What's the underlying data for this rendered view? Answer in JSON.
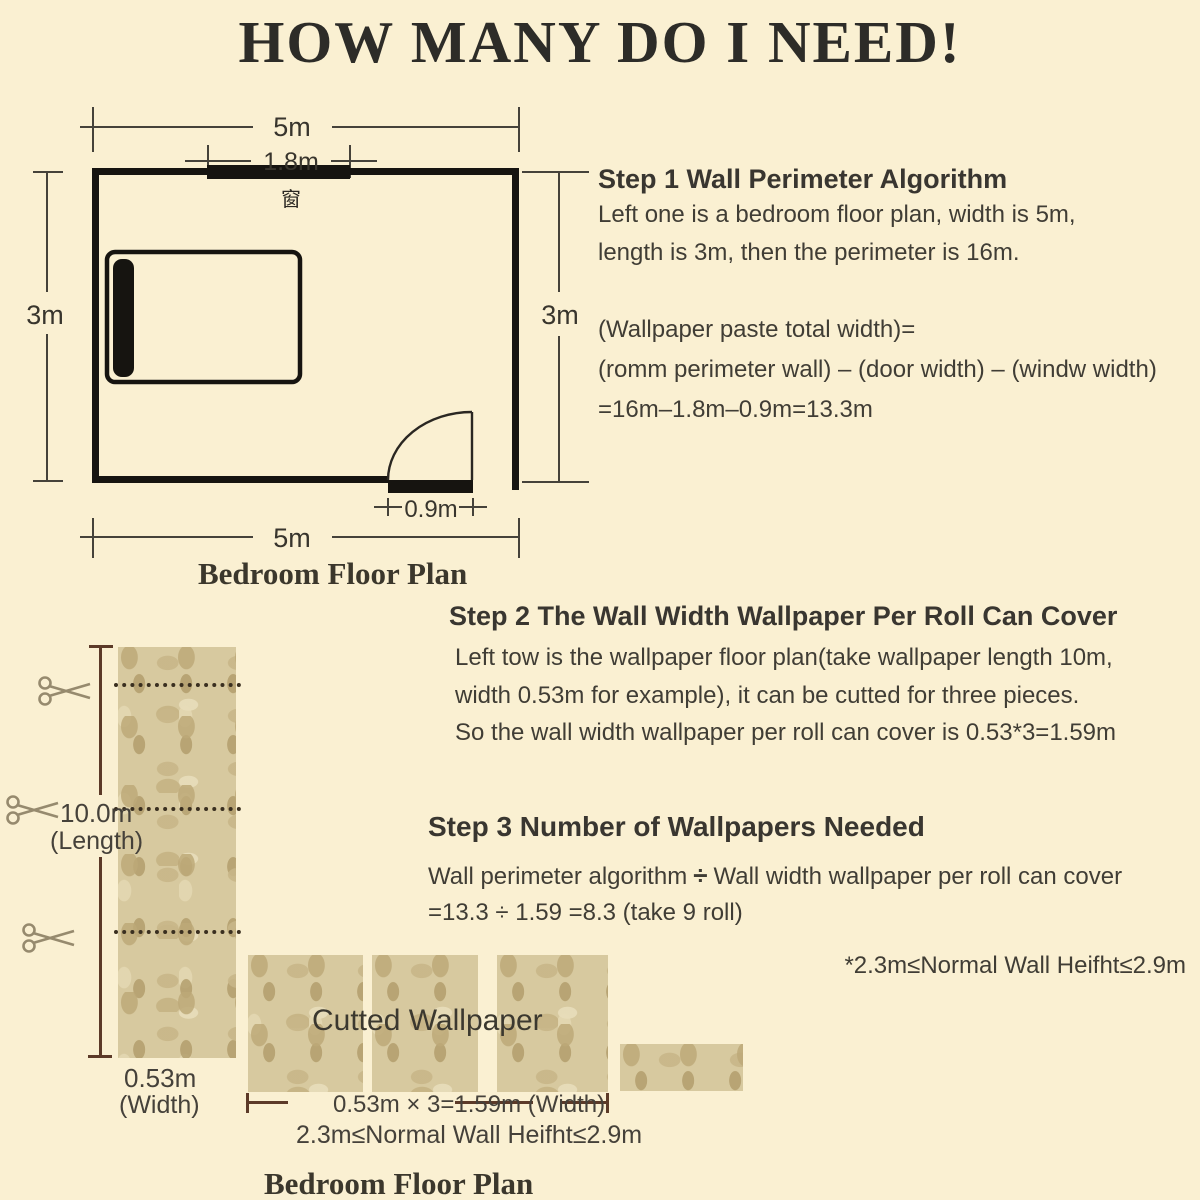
{
  "title": "HOW MANY DO I NEED!",
  "colors": {
    "background": "#faf0d2",
    "body_text": "#403d35",
    "wall_line": "#161410",
    "dimension_line_floorplan": "#45423a",
    "dimension_line_wallpaper": "#5c3a28",
    "wallpaper_base": "#d7c99f",
    "wallpaper_pattern": "#c0ad80",
    "scissors": "#968a6e"
  },
  "floor_plan": {
    "caption": "Bedroom Floor Plan",
    "dim_width_top": "5m",
    "dim_window": "1.8m",
    "dim_left": "3m",
    "dim_right": "3m",
    "dim_door": "0.9m",
    "dim_width_bottom": "5m",
    "window_char": "窗"
  },
  "step1": {
    "heading": "Step 1  Wall Perimeter Algorithm",
    "line1": "Left one is a bedroom floor plan, width is 5m,",
    "line2": "length is 3m, then the perimeter is 16m.",
    "formula1": "(Wallpaper paste total width)=",
    "formula2": "(romm perimeter wall) – (door width) – (windw width)",
    "formula3": "=16m–1.8m–0.9m=13.3m"
  },
  "step2": {
    "heading": "Step 2  The Wall Width Wallpaper Per Roll Can Cover",
    "line1": "Left tow is the wallpaper floor plan(take wallpaper length 10m,",
    "line2": "width 0.53m for example), it can be cutted for three pieces.",
    "line3": "So the wall width wallpaper per roll can cover is 0.53*3=1.59m"
  },
  "step3": {
    "heading": "Step 3  Number of Wallpapers Needed",
    "line1_pre": "Wall perimeter algorithm",
    "line1_divide": "÷",
    "line1_post": "Wall width wallpaper per roll can cover",
    "line2": "=13.3  ÷  1.59 =8.3 (take 9 roll)",
    "note": "*2.3m≤Normal Wall Heifht≤2.9m"
  },
  "roll": {
    "length_label": "10.0m",
    "length_sub": "(Length)",
    "width_label": "0.53m",
    "width_sub": "(Width)"
  },
  "cut": {
    "overlay": "Cutted Wallpaper",
    "width_formula": "0.53m × 3=1.59m (Width)",
    "height_note": "2.3m≤Normal Wall Heifht≤2.9m",
    "caption": "Bedroom Floor Plan"
  }
}
